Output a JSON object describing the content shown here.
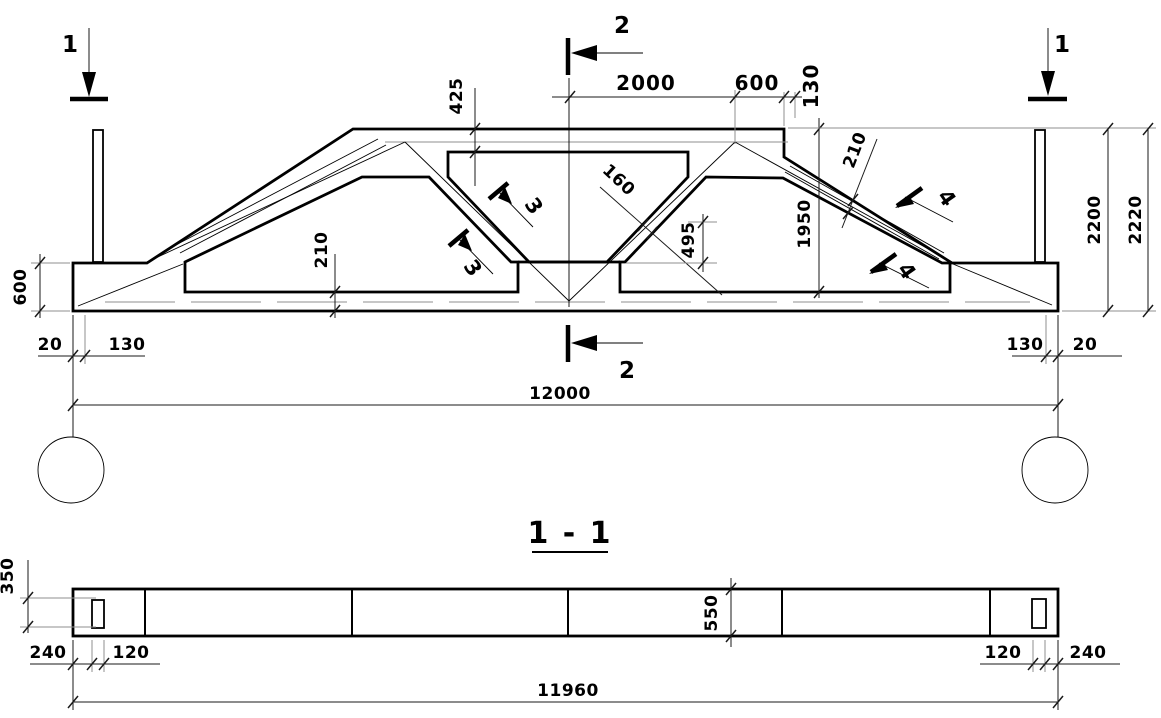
{
  "drawing": {
    "elevation": {
      "marker_1_left": "1",
      "marker_1_right": "1",
      "marker_2_top": "2",
      "marker_2_bottom": "2",
      "marker_3_upper": "3",
      "marker_3_lower": "3",
      "marker_4_upper": "4",
      "marker_4_lower": "4",
      "dim_425": "425",
      "dim_2000": "2000",
      "dim_600_top": "600",
      "dim_130_top": "130",
      "dim_160": "160",
      "dim_210_slope": "210",
      "dim_1950": "1950",
      "dim_2200": "2200",
      "dim_2220": "2220",
      "dim_210_bottom": "210",
      "dim_495": "495",
      "dim_600_left": "600",
      "dim_20_left": "20",
      "dim_130_left": "130",
      "dim_130_right": "130",
      "dim_20_right": "20",
      "dim_12000": "12000"
    },
    "section": {
      "title": "1 - 1",
      "dim_350": "350",
      "dim_550": "550",
      "dim_240_left": "240",
      "dim_120_left": "120",
      "dim_120_right": "120",
      "dim_240_right": "240",
      "dim_11960": "11960"
    }
  }
}
